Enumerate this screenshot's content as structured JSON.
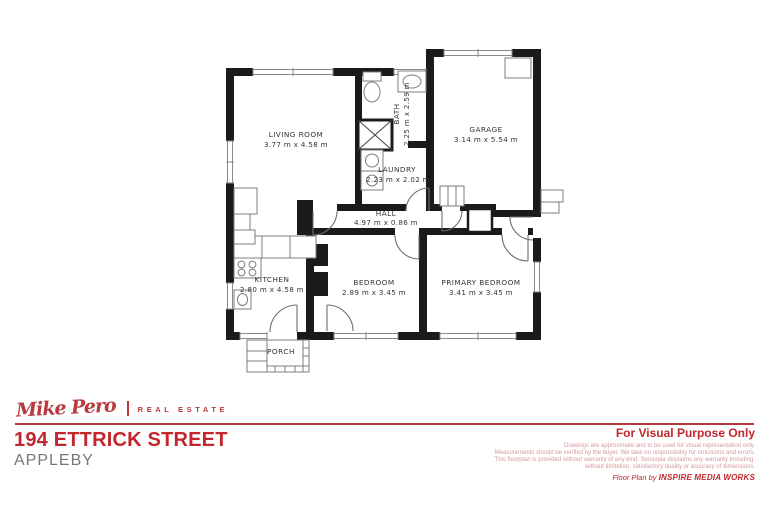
{
  "floorplan": {
    "rooms": [
      {
        "name": "LIVING ROOM",
        "dims": "3.77 m x 4.58 m"
      },
      {
        "name": "BATH",
        "dims": "2.25 m x 2.59 m"
      },
      {
        "name": "GARAGE",
        "dims": "3.14 m x 5.54 m"
      },
      {
        "name": "LAUNDRY",
        "dims": "2.23 m x 2.02 m"
      },
      {
        "name": "HALL",
        "dims": "4.97 m x 0.86 m"
      },
      {
        "name": "KITCHEN",
        "dims": "2.80 m x 4.58 m"
      },
      {
        "name": "BEDROOM",
        "dims": "2.89 m x 3.45 m"
      },
      {
        "name": "PRIMARY BEDROOM",
        "dims": "3.41 m x 3.45 m"
      },
      {
        "name": "PORCH",
        "dims": ""
      }
    ]
  },
  "branding": {
    "logo_script": "Mike Pero",
    "logo_text": "REAL ESTATE"
  },
  "address": {
    "street": "194 ETTRICK STREET",
    "suburb": "APPLEBY"
  },
  "footer": {
    "heading": "For Visual Purpose Only",
    "disclaimer": [
      "Drawings are approximate and to be used for visual representation only.",
      "Measurements should be verified by the buyer. We take no responsibility for omissions and errors.",
      "This floorplan is provided without warranty of any kind. Sensopia disclaims any warranty including,",
      "without limitation, satisfactory quality or accuracy of dimensions."
    ],
    "credit_prefix": "Floor Plan by ",
    "credit_name": "INSPIRE MEDIA WORKS"
  },
  "colors": {
    "brand_red": "#c1272d",
    "light_red": "#d59a9c",
    "suburb_gray": "#76777a",
    "wall_black": "#1b1b1b"
  }
}
